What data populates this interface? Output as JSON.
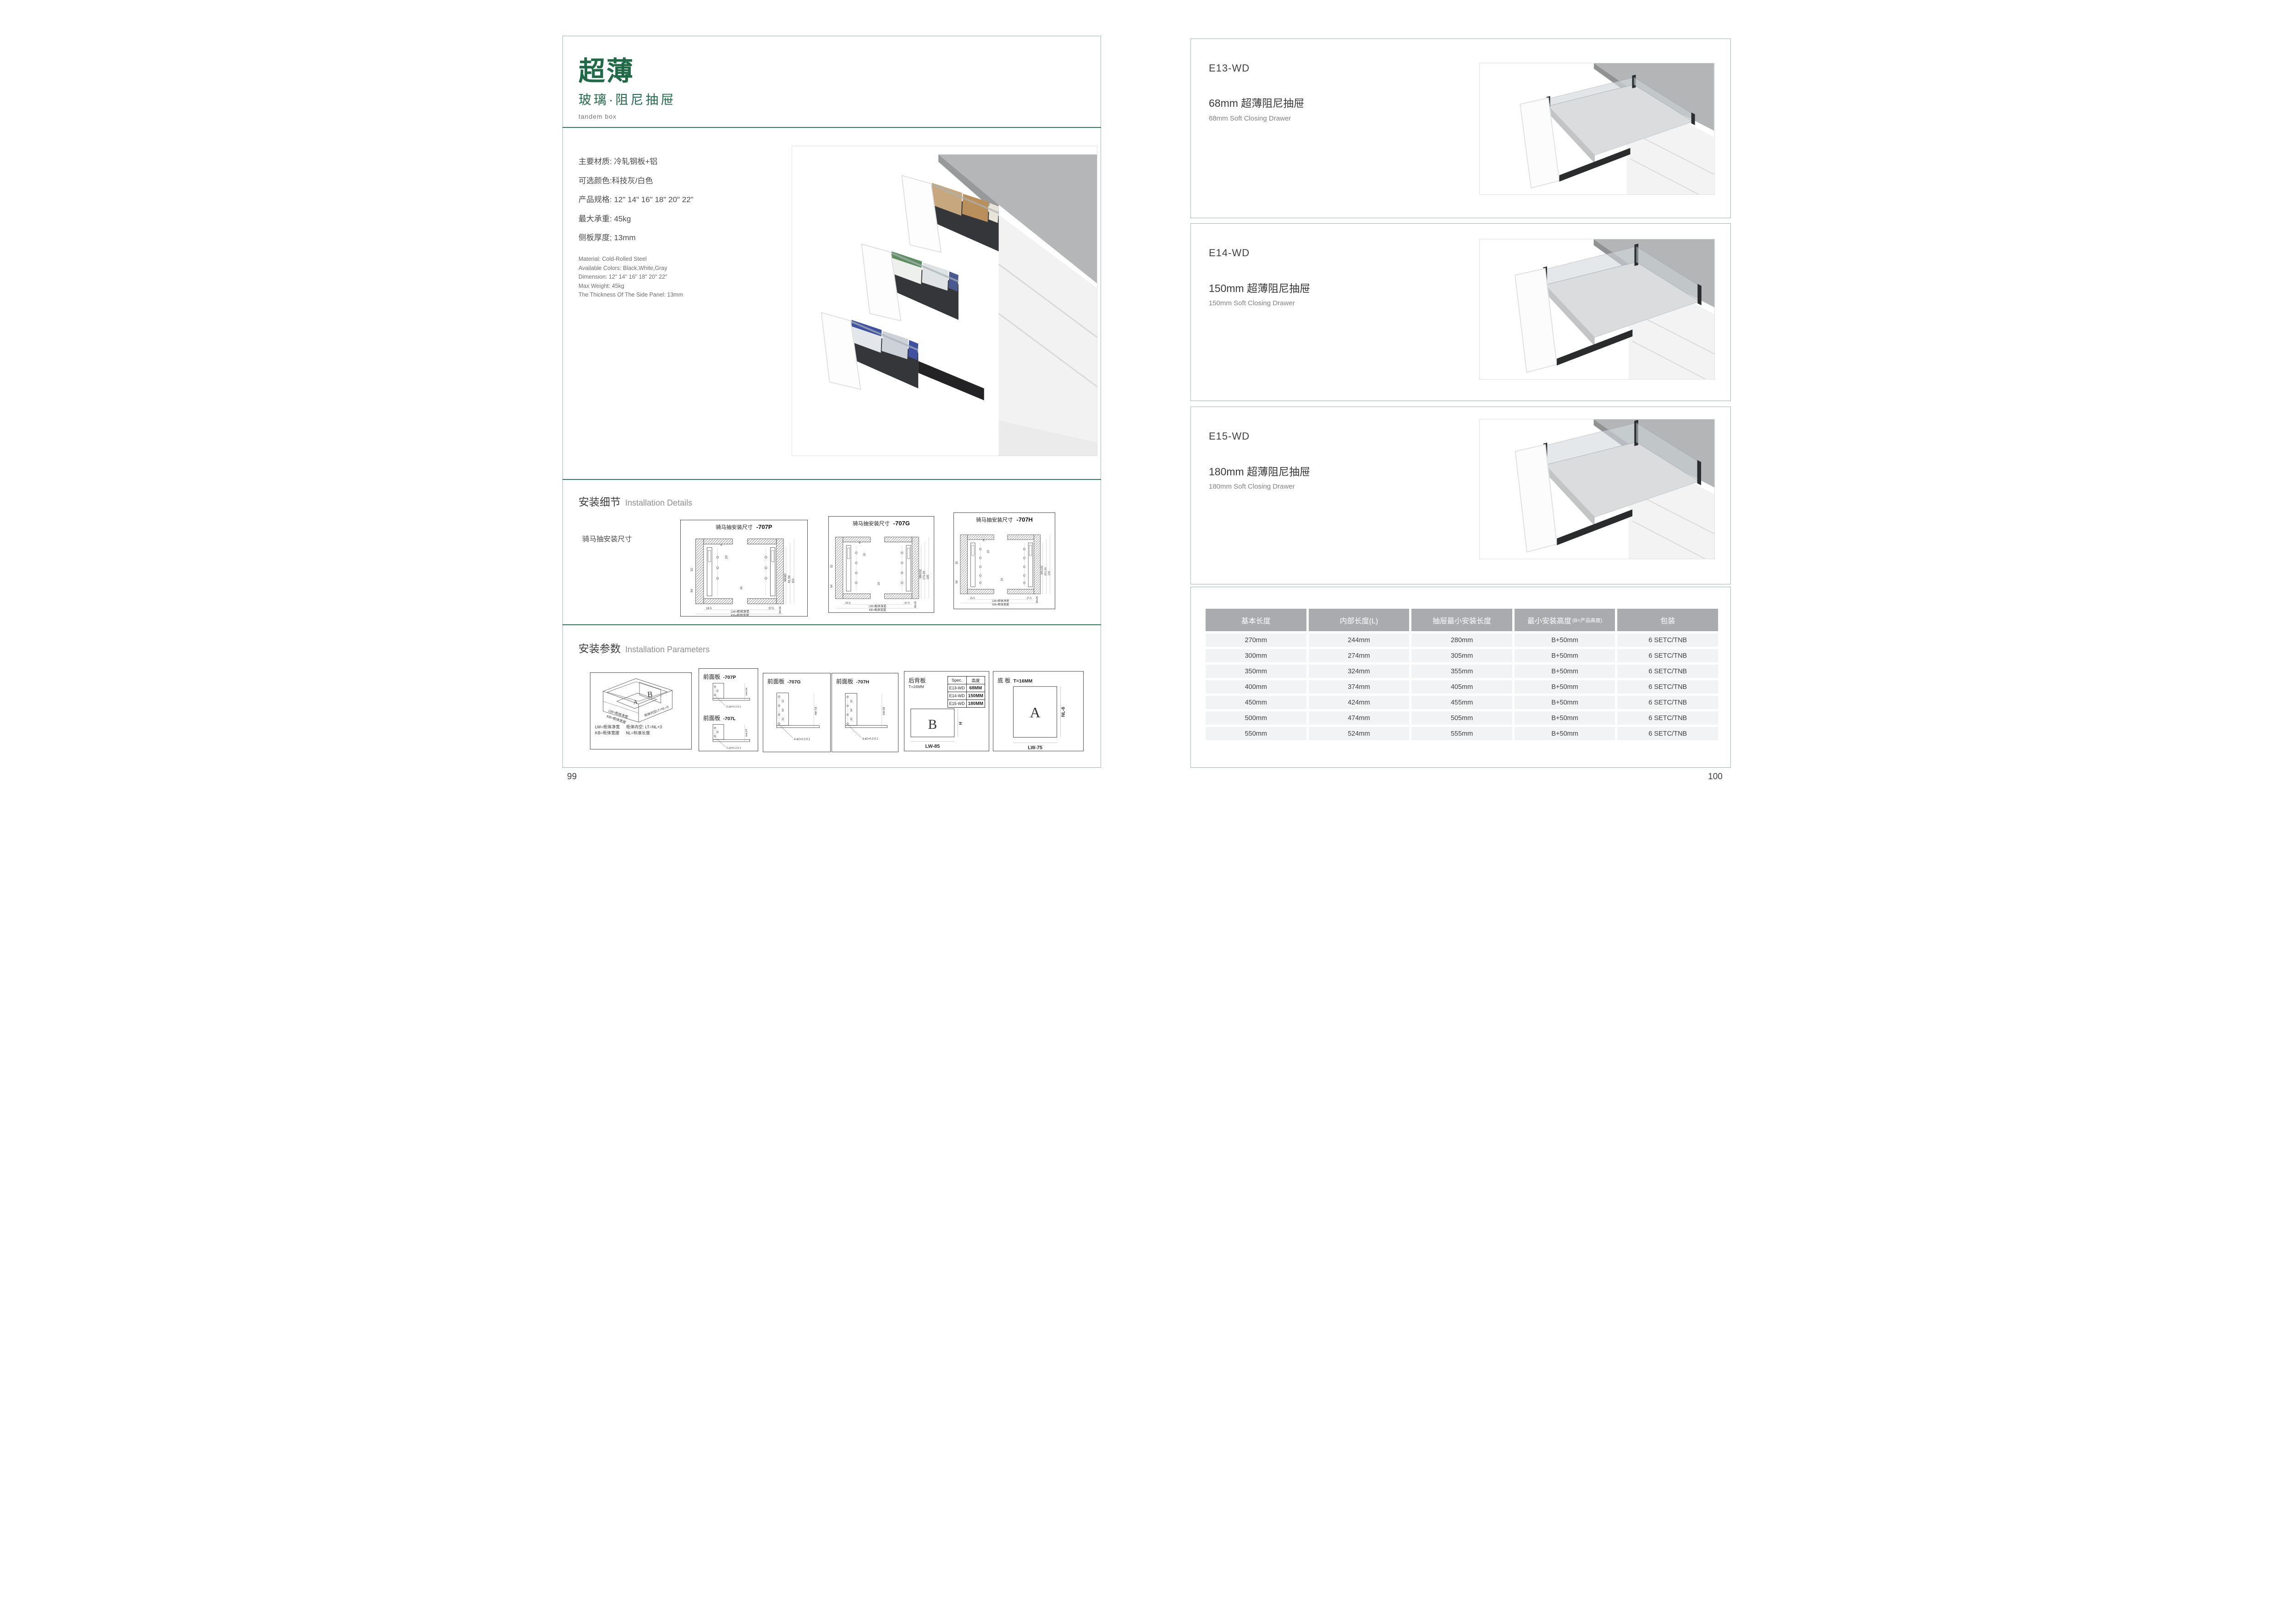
{
  "left": {
    "title": "超薄",
    "subtitle": "玻璃·阻尼抽屉",
    "tagline": "tandem box",
    "specs_cn": [
      "主要材质: 冷轧钢板+铝",
      "可选颜色:科技灰/白色",
      "产品规格: 12\" 14\" 16\" 18\" 20\" 22\"",
      "最大承重: 45kg",
      "侧板厚度; 13mm"
    ],
    "specs_en": [
      "Material: Cold-Rolled Steel",
      "Available Colors: Black,White,Gray",
      "Dimension: 12\" 14\" 16\" 18\" 20\" 22\"",
      "Max Weight: 45kg",
      "The Thickness Of The Side Panel: 13mm"
    ],
    "details": {
      "title": "安装细节",
      "title_en": "Installation Details",
      "subtitle": "骑马抽安装尺寸",
      "dims": {
        "a": "9",
        "b": "20",
        "c": "32",
        "d": "16",
        "e": "54",
        "f": "16.5",
        "g": "37.5",
        "h": "Min36",
        "lw": "LW=柜体净宽",
        "kb": "KB=柜体宽度"
      },
      "drawings": [
        {
          "title": "骑马抽安装尺寸",
          "code": "-707P",
          "d1": "Min82",
          "d2": "91.50",
          "d3": "113"
        },
        {
          "title": "骑马抽安装尺寸",
          "code": "-707G",
          "d1": "Min162",
          "d2": "171.50",
          "d3": "195"
        },
        {
          "title": "骑马抽安装尺寸",
          "code": "-707H",
          "d1": "Min192",
          "d2": "201.50",
          "d3": "225"
        }
      ]
    },
    "params": {
      "title": "安装参数",
      "title_en": "Installation Parameters",
      "iso": {
        "a": "A",
        "b": "B",
        "lw": "LW=柜体净宽",
        "kb": "KB=柜体宽度",
        "lt": "柜体内空LT=NL+3",
        "legend1": "LW=柜体净宽",
        "legend2": "柜体内空: LT=NL+3",
        "legend3": "KB=柜体宽度",
        "legend4": "NL=标准长度"
      },
      "panels": [
        {
          "title": "前面板",
          "code": "-707P",
          "dim1": "32",
          "dim2": "min 54",
          "callout": "2-ø2+0.2-0.1"
        },
        {
          "title": "前面板",
          "code": "-707L",
          "dim1": "32",
          "dim2": "min 54",
          "callout": "2-ø2+0.2-0.1"
        },
        {
          "title": "前面板",
          "code": "-707G",
          "dim1": "32",
          "dim2": "64",
          "dim3": "32",
          "dim4": "min 54",
          "callout": "4-ø2+0.2-0.1"
        },
        {
          "title": "前面板",
          "code": "-707H",
          "dim1": "32",
          "dim2": "64",
          "dim3": "32",
          "dim4": "min 54",
          "callout": "4-ø2+0.2-0.1"
        }
      ],
      "back_panel": {
        "title": "后背板",
        "note": "T=16MM",
        "spec_header1": "Spec.",
        "spec_header2": "高度",
        "specs": [
          [
            "E13-WD",
            "68MM"
          ],
          [
            "E14-WD",
            "150MM"
          ],
          [
            "E15-WD",
            "180MM"
          ]
        ],
        "label": "B",
        "h": "H",
        "w": "LW-85"
      },
      "bottom_panel": {
        "title": "底 板",
        "note": "T=16MM",
        "label": "A",
        "h": "NL-6",
        "w": "LW-75"
      }
    },
    "page_number": "99"
  },
  "right": {
    "products": [
      {
        "code": "E13-WD",
        "name_cn": "68mm 超薄阻尼抽屉",
        "name_en": "68mm Soft Closing Drawer"
      },
      {
        "code": "E14-WD",
        "name_cn": "150mm 超薄阻尼抽屉",
        "name_en": "150mm Soft Closing Drawer"
      },
      {
        "code": "E15-WD",
        "name_cn": "180mm 超薄阻尼抽屉",
        "name_en": "180mm Soft Closing Drawer"
      }
    ],
    "table": {
      "headers": [
        "基本长度",
        "内部长度(L)",
        "抽屉最小安装长度",
        "最小安装高度",
        "包装"
      ],
      "header4_note": "(B=产品高度)",
      "rows": [
        [
          "270mm",
          "244mm",
          "280mm",
          "B+50mm",
          "6 SETC/TNB"
        ],
        [
          "300mm",
          "274mm",
          "305mm",
          "B+50mm",
          "6 SETC/TNB"
        ],
        [
          "350mm",
          "324mm",
          "355mm",
          "B+50mm",
          "6 SETC/TNB"
        ],
        [
          "400mm",
          "374mm",
          "405mm",
          "B+50mm",
          "6 SETC/TNB"
        ],
        [
          "450mm",
          "424mm",
          "455mm",
          "B+50mm",
          "6 SETC/TNB"
        ],
        [
          "500mm",
          "474mm",
          "505mm",
          "B+50mm",
          "6 SETC/TNB"
        ],
        [
          "550mm",
          "524mm",
          "555mm",
          "B+50mm",
          "6 SETC/TNB"
        ]
      ]
    },
    "page_number": "100"
  }
}
